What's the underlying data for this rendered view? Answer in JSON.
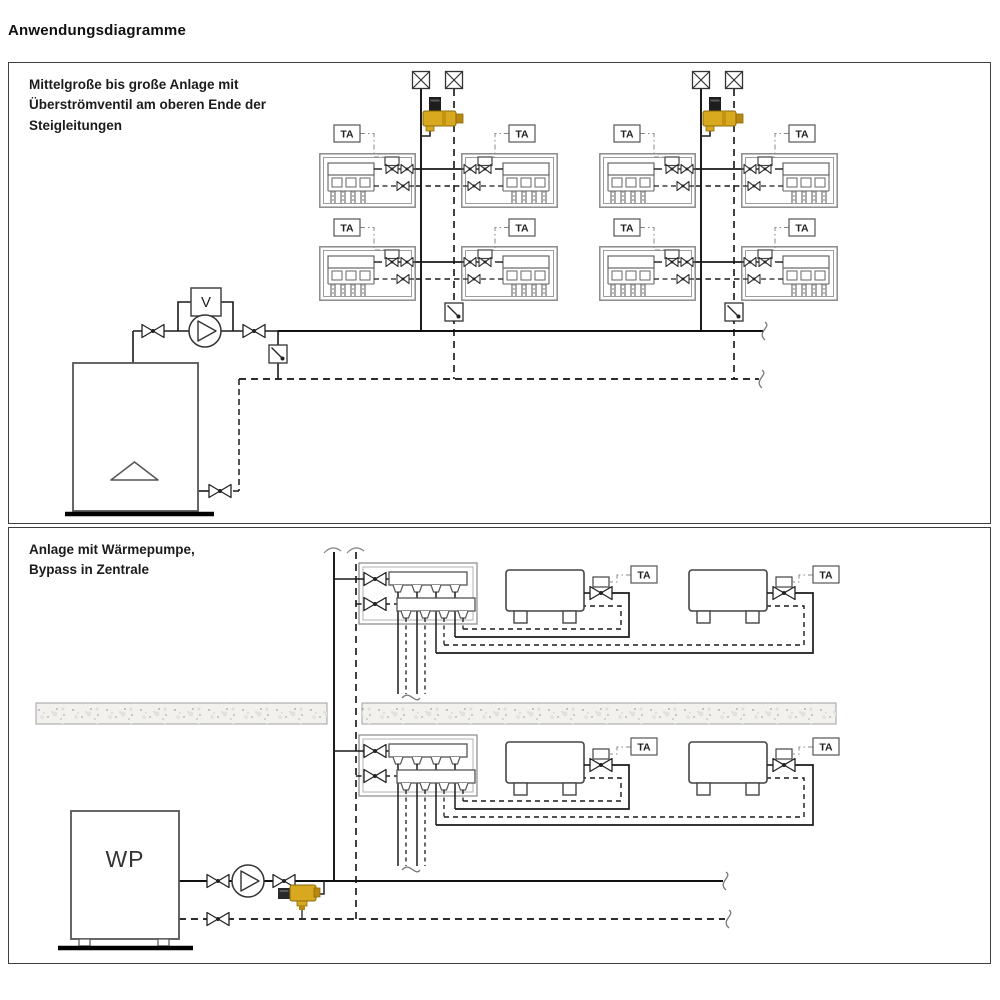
{
  "page": {
    "title": "Anwendungsdiagramme"
  },
  "panels": [
    {
      "title_lines": [
        "Mittelgroße bis große Anlage mit",
        "Überströmventil am oberen Ende der",
        "Steigleitungen"
      ]
    },
    {
      "title_lines": [
        "Anlage mit Wärmepumpe,",
        "Bypass in Zentrale"
      ]
    }
  ],
  "labels": {
    "thermostat": "TA",
    "volume_flow_indicator": "V",
    "heat_pump": "WP"
  },
  "colors": {
    "line": "#1a1a1a",
    "component_stroke": "#555555",
    "panel_border": "#3f3f3f",
    "brass_body": "#d8a81e",
    "brass_dark": "#8a6a0e",
    "valve_cap_dark": "#222222",
    "slab_fill": "#f2f1ee",
    "background": "#ffffff"
  }
}
